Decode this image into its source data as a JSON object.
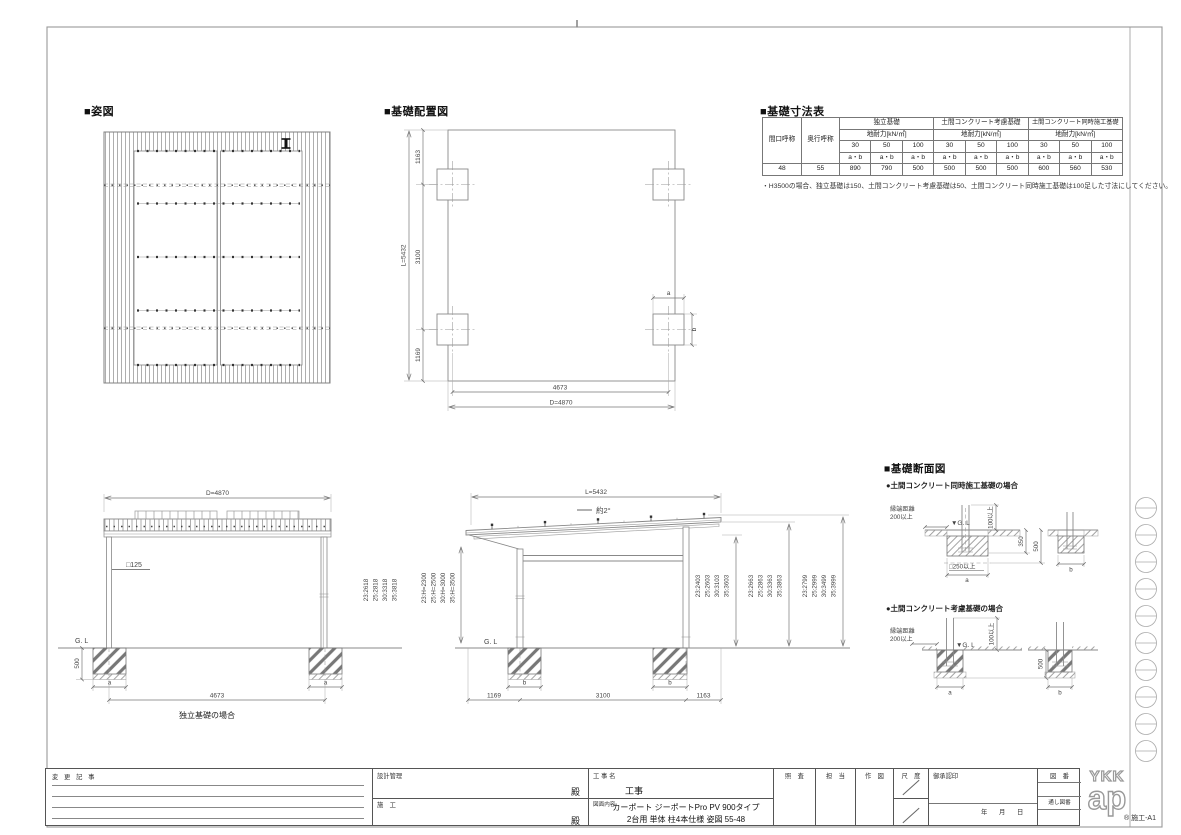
{
  "plan": {
    "title": "■姿図"
  },
  "layout": {
    "title": "■基礎配置図",
    "l_total": "L=5432",
    "seg_top": "1163",
    "seg_mid": "3100",
    "seg_bot": "1169",
    "w_inner": "4673",
    "w_total": "D=4870",
    "dim_a": "a",
    "dim_b": "b"
  },
  "table": {
    "title": "■基礎寸法表",
    "col_span_label": "間口呼称",
    "col_depth_label": "奥行呼称",
    "groups": [
      {
        "label": "独立基礎"
      },
      {
        "label": "土間コンクリート考慮基礎"
      },
      {
        "label": "土間コンクリート同時施工基礎"
      }
    ],
    "soil_label": "地耐力[kN/㎡]",
    "soil_values": [
      "30",
      "50",
      "100"
    ],
    "ab_label": "a・b",
    "row": [
      "48",
      "55",
      "890",
      "790",
      "500",
      "500",
      "500",
      "500",
      "600",
      "560",
      "530"
    ],
    "note": "・H3500の場合、独立基礎は150、土間コンクリート考慮基礎は50、土間コンクリート同時施工基礎は100足した寸法にしてください。"
  },
  "front": {
    "dim_total": "D=4870",
    "post_label": "□125",
    "gl": "G. L",
    "depth": "500",
    "dim_a_left": "a",
    "dim_a_right": "a",
    "dim_span": "4673",
    "caption": "独立基礎の場合",
    "heights": [
      "23:2618",
      "25:2818",
      "30:3318",
      "35:3818"
    ],
    "h_values": [
      "23:H=2300",
      "25:H=2500",
      "30:H=3000",
      "35:H=3500"
    ]
  },
  "side": {
    "dim_total": "L=5432",
    "slope": "約2°",
    "gl": "G. L",
    "dim_b_front": "b",
    "dim_b_rear": "b",
    "dim_left": "1169",
    "dim_mid": "3100",
    "dim_right": "1163",
    "stack1": [
      "23:2403",
      "25:2603",
      "30:3103",
      "35:3603"
    ],
    "stack2": [
      "23:2663",
      "25:2863",
      "30:3363",
      "35:3863"
    ],
    "stack3": [
      "23:2799",
      "25:2999",
      "30:3499",
      "35:3999"
    ]
  },
  "sections": {
    "title": "■基礎断面図",
    "sub1": {
      "title": "●土間コンクリート同時施工基礎の場合",
      "edge_label": "縁端距離",
      "edge_value": "200以上",
      "gl": "▼G. L",
      "clear": "100以上",
      "d350": "350",
      "d500": "500",
      "base": "□250以上",
      "a": "a",
      "b": "b"
    },
    "sub2": {
      "title": "●土間コンクリート考慮基礎の場合",
      "edge_label": "縁端距離",
      "edge_value": "200以上",
      "gl": "▼G. L",
      "clear": "100以上",
      "d500": "500",
      "a": "a",
      "b": "b"
    }
  },
  "titleblock": {
    "change_label": "変 更 記 事",
    "design_label": "設計管理",
    "design_suffix": "殿",
    "construct_label": "施　工",
    "construct_suffix": "殿",
    "project_label": "工 事 名",
    "project_suffix": "工事",
    "content_label": "図面内容",
    "content_line1": "カーポート ジーポートPro PV 900タイプ",
    "content_line2": "2台用 単体 柱4本仕様 姿図 55-48",
    "check_label": "照　査",
    "charge_label": "担　当",
    "draw_label": "作　図",
    "scale_label": "尺　度",
    "approval_label": "御承認印",
    "year": "年",
    "month": "月",
    "day": "日",
    "number_label": "図　番",
    "through_label": "通し図番",
    "logo_top": "YKK",
    "logo_bottom": "ap",
    "doc_code": "® 施工-A1"
  }
}
